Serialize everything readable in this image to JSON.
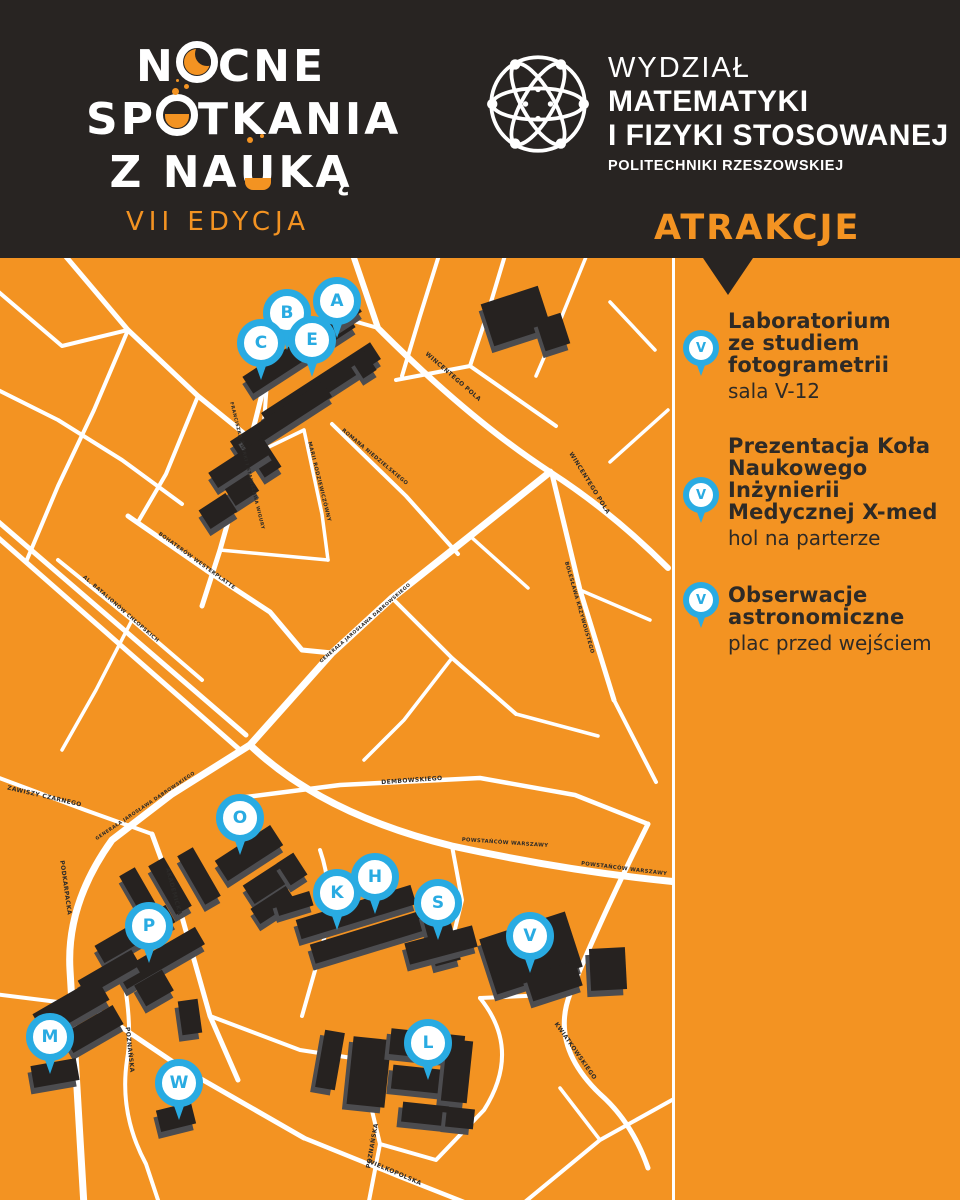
{
  "header": {
    "logo": {
      "l1a": "N",
      "l1o": "O",
      "l1b": "CNE",
      "l2a": "SP",
      "l2o": "O",
      "l2b": "TKANIA",
      "l3a": "Z NA",
      "l3u": "U",
      "l3b": "KĄ",
      "edition": "VII EDYCJA"
    },
    "faculty": {
      "line1": "WYDZIAŁ",
      "line2": "MATEMATYKI",
      "line3": "I FIZYKI STOSOWANEJ",
      "line4": "POLITECHNIKI RZESZOWSKIEJ"
    },
    "section_title": "ATRAKCJE"
  },
  "attractions": [
    {
      "pin": "V",
      "title": "Laboratorium\nze studiem\nfotogrametrii",
      "location": "sala V-12"
    },
    {
      "pin": "V",
      "title": "Prezentacja Koła\nNaukowego Inżynierii\nMedycznej X-med",
      "location": "hol na parterze"
    },
    {
      "pin": "V",
      "title": "Obserwacje\nastronomiczne",
      "location": "plac przed wejściem"
    }
  ],
  "map": {
    "markers": [
      {
        "letter": "A"
      },
      {
        "letter": "B"
      },
      {
        "letter": "C"
      },
      {
        "letter": "E"
      },
      {
        "letter": "O"
      },
      {
        "letter": "K"
      },
      {
        "letter": "H"
      },
      {
        "letter": "S"
      },
      {
        "letter": "V"
      },
      {
        "letter": "P"
      },
      {
        "letter": "M"
      },
      {
        "letter": "W"
      },
      {
        "letter": "L"
      }
    ],
    "streets": [
      {
        "name": "WINCENTEGO POLA"
      },
      {
        "name": "WINCENTEGO POLA"
      },
      {
        "name": "FRANCISZKA ŻWIRKI I STANISŁAWA WIGURY"
      },
      {
        "name": "MARII RODZIEWICZÓWNY"
      },
      {
        "name": "ROMANA NIEDZIELSKIEGO"
      },
      {
        "name": "BOHATERÓW WESTERPLATTE"
      },
      {
        "name": "AL. BATALIONÓW CHŁOPSKICH"
      },
      {
        "name": "GENERAŁA JAROSŁAWA DĄBROWSKIEGO"
      },
      {
        "name": "GENERAŁA JAROSŁAWA DĄBROWSKIEGO"
      },
      {
        "name": "BOLESŁAWA KRZYWOUSTEGO"
      },
      {
        "name": "DEMBOWSKIEGO"
      },
      {
        "name": "ZAWISZY CZARNEGO"
      },
      {
        "name": "POWSTAŃCÓW WARSZAWY"
      },
      {
        "name": "POWSTAŃCÓW WARSZAWY"
      },
      {
        "name": "PODKARPACKA"
      },
      {
        "name": "AKADEMICKA"
      },
      {
        "name": "POZNAŃSKA"
      },
      {
        "name": "KWIATKOWSKIEGO"
      },
      {
        "name": "POZNAŃSKA"
      },
      {
        "name": "WIELKOPOLSKA"
      }
    ]
  },
  "colors": {
    "orange": "#F39322",
    "dark": "#282422",
    "blue": "#29ABE2",
    "road": "#FFFFFF"
  }
}
